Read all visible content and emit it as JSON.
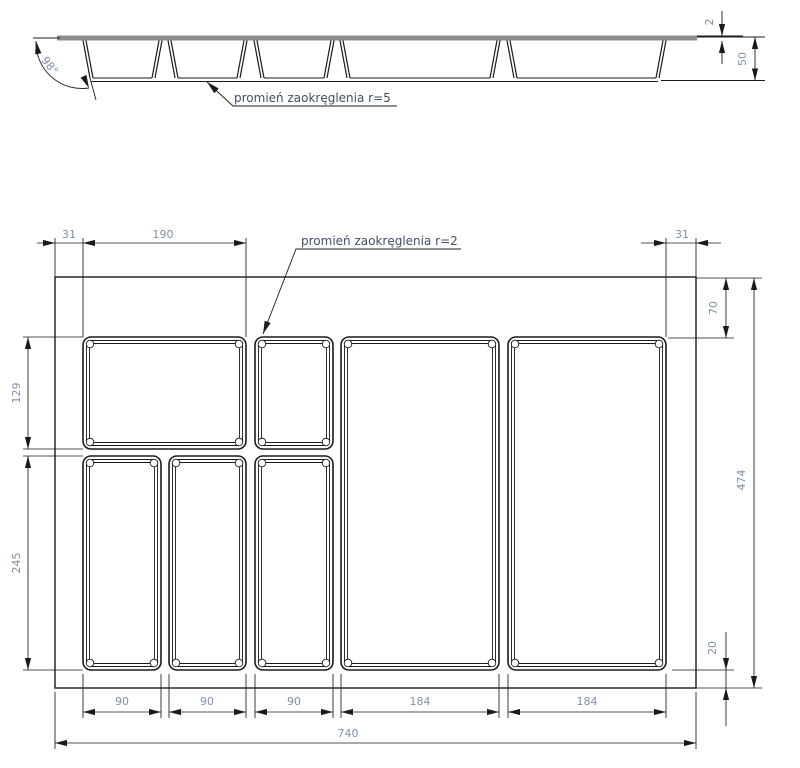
{
  "section_view": {
    "angle": "98°",
    "wall_thickness": "2",
    "height": "50",
    "radius_note": "promień zaokręglenia r=5"
  },
  "plan_view": {
    "radius_note": "promień zaokręglenia r=2",
    "top": {
      "left_rim": "31",
      "first_compartment": "190",
      "right_rim": "31"
    },
    "left": {
      "top_row_height": "129",
      "bottom_row_height": "245"
    },
    "right": {
      "top_inset": "70",
      "overall_height": "474",
      "bottom_inset": "20"
    },
    "bottom": {
      "w1": "90",
      "w2": "90",
      "w3": "90",
      "w4": "184",
      "w5": "184",
      "total_width": "740"
    }
  }
}
